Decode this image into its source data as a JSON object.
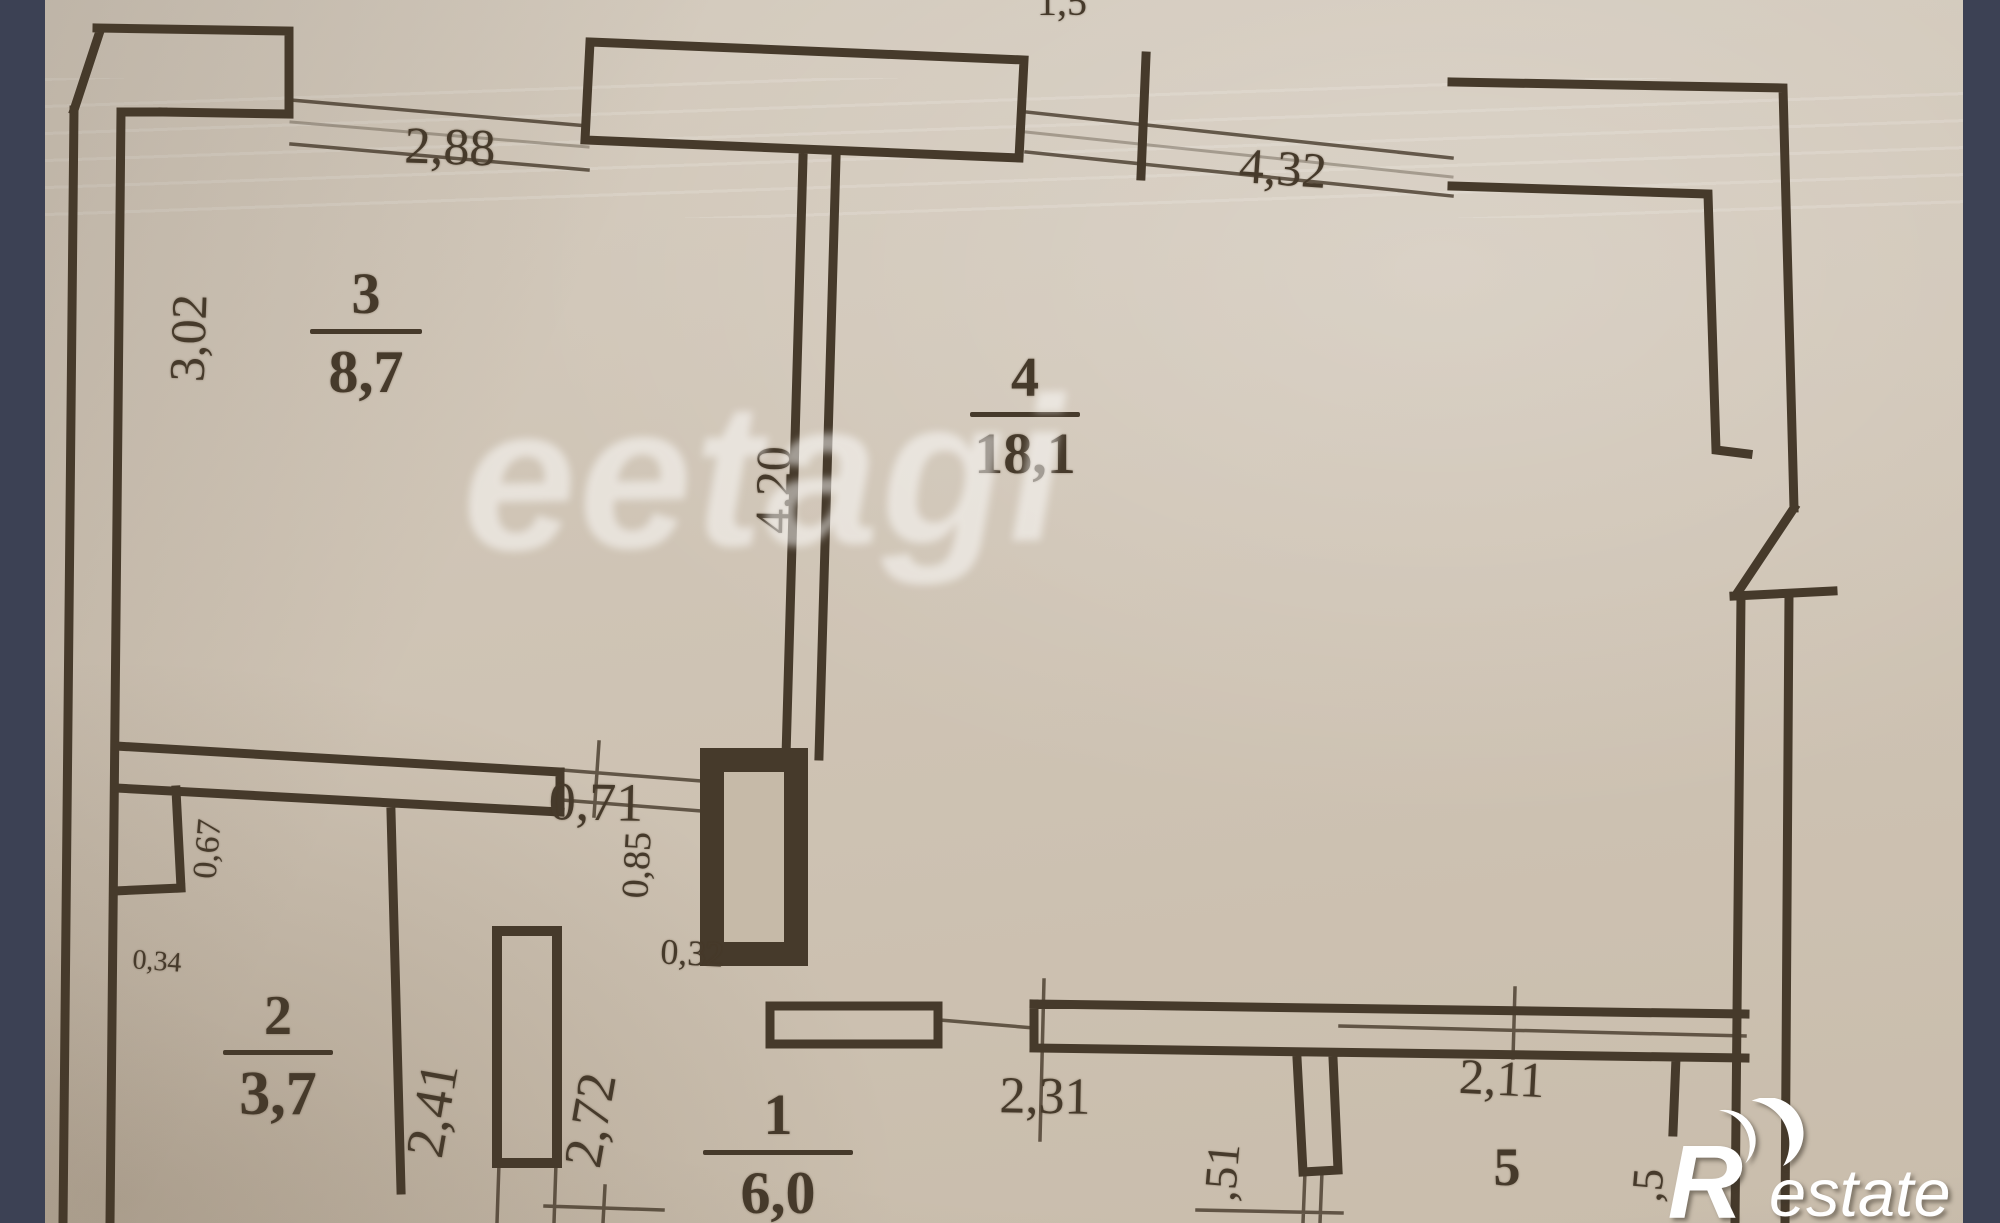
{
  "colors": {
    "letterbox": "#3c4154",
    "paper": "#cfc4b5",
    "ink": "#463a2b",
    "watermark": "#ffffff"
  },
  "watermark": {
    "text": "eetagi"
  },
  "brand": {
    "initial": "R",
    "rest": "estate"
  },
  "rooms": {
    "r3": {
      "number": "3",
      "area": "8,7"
    },
    "r4": {
      "number": "4",
      "area": "18,1"
    },
    "r2": {
      "number": "2",
      "area": "3,7"
    },
    "r1": {
      "number": "1",
      "area": "6,0"
    },
    "r5": {
      "number": "5"
    }
  },
  "dims": {
    "top_15": "1,5",
    "w_288": "2,88",
    "w_432": "4,32",
    "h_302": "3,02",
    "h_420": "4,20",
    "w_071": "0,71",
    "h_085": "0,85",
    "w_032": "0,32",
    "h_067": "0,67",
    "w_034": "0,34",
    "h_241": "2,41",
    "h_272": "2,72",
    "w_231": "2,31",
    "h_51": ",51",
    "w_211": "2,11",
    "h_5": ",5"
  }
}
